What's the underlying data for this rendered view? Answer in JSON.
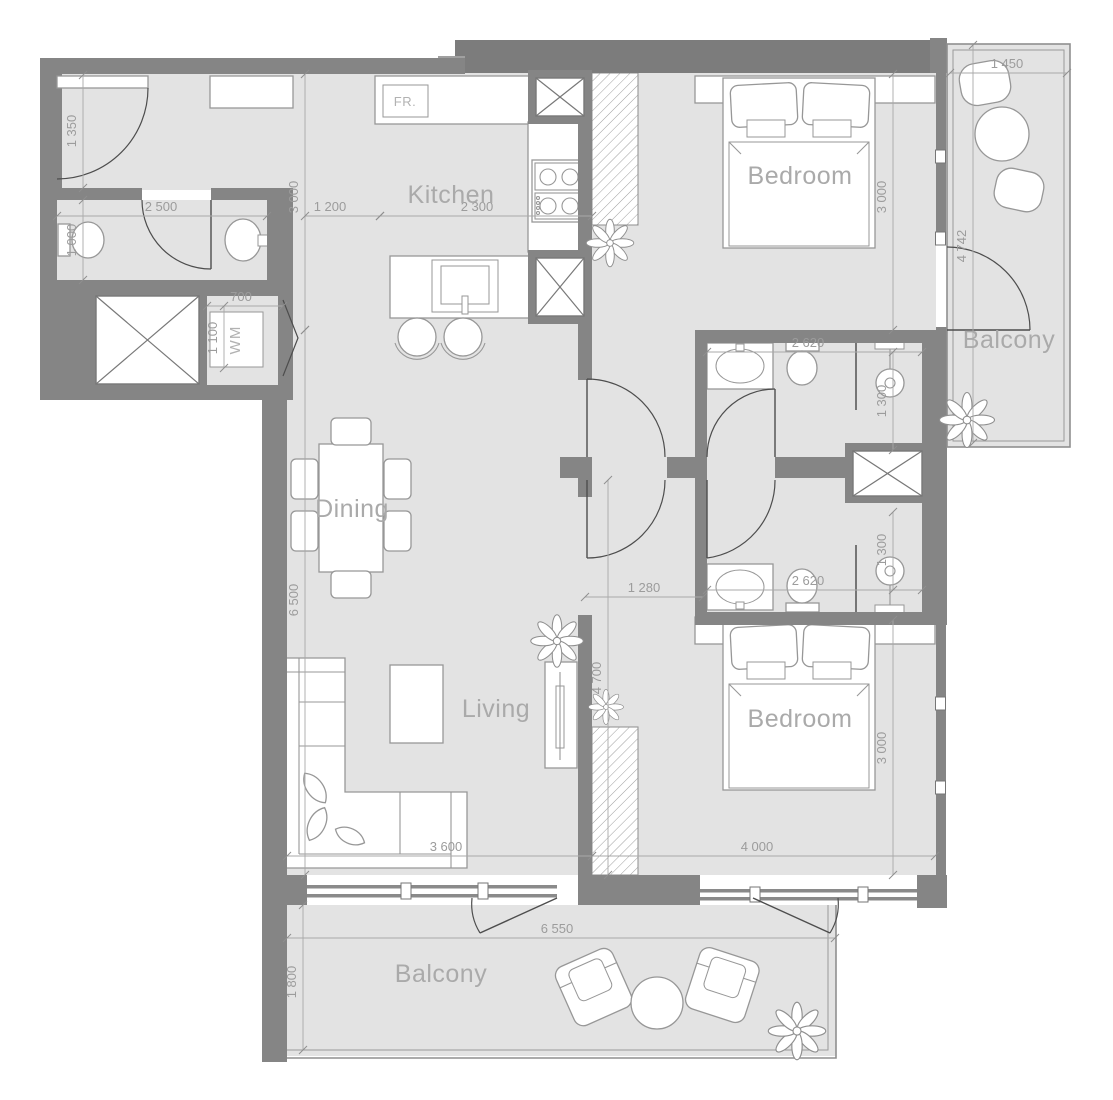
{
  "colors": {
    "wall": "#858585",
    "wall_dark": "#7c7c7c",
    "floor": "#e3e3e3",
    "fixture_stroke": "#979797",
    "door_swing": "#4d4d4d",
    "dimension_line": "#a9a9a9",
    "dimension_text": "#9c9c9c",
    "room_label": "#aaaaaa"
  },
  "room_labels": [
    {
      "name": "kitchen",
      "text": "Kitchen",
      "x": 451,
      "y": 203
    },
    {
      "name": "dining",
      "text": "Dining",
      "x": 352,
      "y": 517
    },
    {
      "name": "living",
      "text": "Living",
      "x": 496,
      "y": 717
    },
    {
      "name": "bedroom-1",
      "text": "Bedroom",
      "x": 800,
      "y": 184
    },
    {
      "name": "bedroom-2",
      "text": "Bedroom",
      "x": 800,
      "y": 727
    },
    {
      "name": "balcony-upper",
      "text": "Balcony",
      "x": 1009,
      "y": 348
    },
    {
      "name": "balcony-lower",
      "text": "Balcony",
      "x": 441,
      "y": 982
    }
  ],
  "appliance_labels": [
    {
      "name": "fridge",
      "text": "FR.",
      "x": 405,
      "y": 106,
      "rot": false
    },
    {
      "name": "washing-machine",
      "text": "WM",
      "x": 240,
      "y": 340,
      "rot": true
    }
  ],
  "dimensions": [
    {
      "text": "1 350",
      "x1": 83,
      "y1": 75,
      "x2": 83,
      "y2": 188,
      "lx": 76,
      "ly": 131,
      "rot": true
    },
    {
      "text": "1 000",
      "x1": 83,
      "y1": 200,
      "x2": 83,
      "y2": 280,
      "lx": 76,
      "ly": 240,
      "rot": true
    },
    {
      "text": "2 500",
      "x1": 57,
      "y1": 216,
      "x2": 267,
      "y2": 216,
      "lx": 161,
      "ly": 211,
      "rot": false
    },
    {
      "text": "3 000",
      "x1": 305,
      "y1": 74,
      "x2": 305,
      "y2": 330,
      "lx": 298,
      "ly": 197,
      "rot": true
    },
    {
      "text": "1 200",
      "x1": 305,
      "y1": 216,
      "x2": 380,
      "y2": 216,
      "lx": 330,
      "ly": 211,
      "rot": false
    },
    {
      "text": "2 300",
      "x1": 380,
      "y1": 216,
      "x2": 592,
      "y2": 216,
      "lx": 477,
      "ly": 211,
      "rot": false
    },
    {
      "text": "700",
      "x1": 207,
      "y1": 306,
      "x2": 283,
      "y2": 306,
      "lx": 241,
      "ly": 301,
      "rot": false
    },
    {
      "text": "1 100",
      "x1": 224,
      "y1": 306,
      "x2": 224,
      "y2": 368,
      "lx": 217,
      "ly": 338,
      "rot": true
    },
    {
      "text": "6 500",
      "x1": 305,
      "y1": 330,
      "x2": 305,
      "y2": 875,
      "lx": 298,
      "ly": 600,
      "rot": true
    },
    {
      "text": "3 600",
      "x1": 287,
      "y1": 856,
      "x2": 592,
      "y2": 856,
      "lx": 446,
      "ly": 851,
      "rot": false
    },
    {
      "text": "4 700",
      "x1": 608,
      "y1": 480,
      "x2": 608,
      "y2": 875,
      "lx": 601,
      "ly": 678,
      "rot": true
    },
    {
      "text": "1 280",
      "x1": 585,
      "y1": 597,
      "x2": 703,
      "y2": 597,
      "lx": 644,
      "ly": 592,
      "rot": false
    },
    {
      "text": "4 000",
      "x1": 592,
      "y1": 856,
      "x2": 935,
      "y2": 856,
      "lx": 757,
      "ly": 851,
      "rot": false
    },
    {
      "text": "3 000",
      "x1": 893,
      "y1": 620,
      "x2": 893,
      "y2": 875,
      "lx": 886,
      "ly": 748,
      "rot": true
    },
    {
      "text": "3 000",
      "x1": 893,
      "y1": 74,
      "x2": 893,
      "y2": 330,
      "lx": 886,
      "ly": 197,
      "rot": true
    },
    {
      "text": "2 620",
      "x1": 707,
      "y1": 352,
      "x2": 922,
      "y2": 352,
      "lx": 808,
      "ly": 347,
      "rot": false
    },
    {
      "text": "1 300",
      "x1": 893,
      "y1": 352,
      "x2": 893,
      "y2": 450,
      "lx": 886,
      "ly": 401,
      "rot": true
    },
    {
      "text": "2 620",
      "x1": 707,
      "y1": 590,
      "x2": 922,
      "y2": 590,
      "lx": 808,
      "ly": 585,
      "rot": false
    },
    {
      "text": "1 300",
      "x1": 893,
      "y1": 512,
      "x2": 893,
      "y2": 590,
      "lx": 886,
      "ly": 550,
      "rot": true
    },
    {
      "text": "1 450",
      "x1": 950,
      "y1": 73,
      "x2": 1067,
      "y2": 73,
      "lx": 1007,
      "ly": 68,
      "rot": false
    },
    {
      "text": "4 742",
      "x1": 973,
      "y1": 45,
      "x2": 973,
      "y2": 443,
      "lx": 966,
      "ly": 246,
      "rot": true
    },
    {
      "text": "6 550",
      "x1": 287,
      "y1": 938,
      "x2": 835,
      "y2": 938,
      "lx": 557,
      "ly": 933,
      "rot": false
    },
    {
      "text": "1 800",
      "x1": 303,
      "y1": 905,
      "x2": 303,
      "y2": 1050,
      "lx": 296,
      "ly": 982,
      "rot": true
    }
  ]
}
